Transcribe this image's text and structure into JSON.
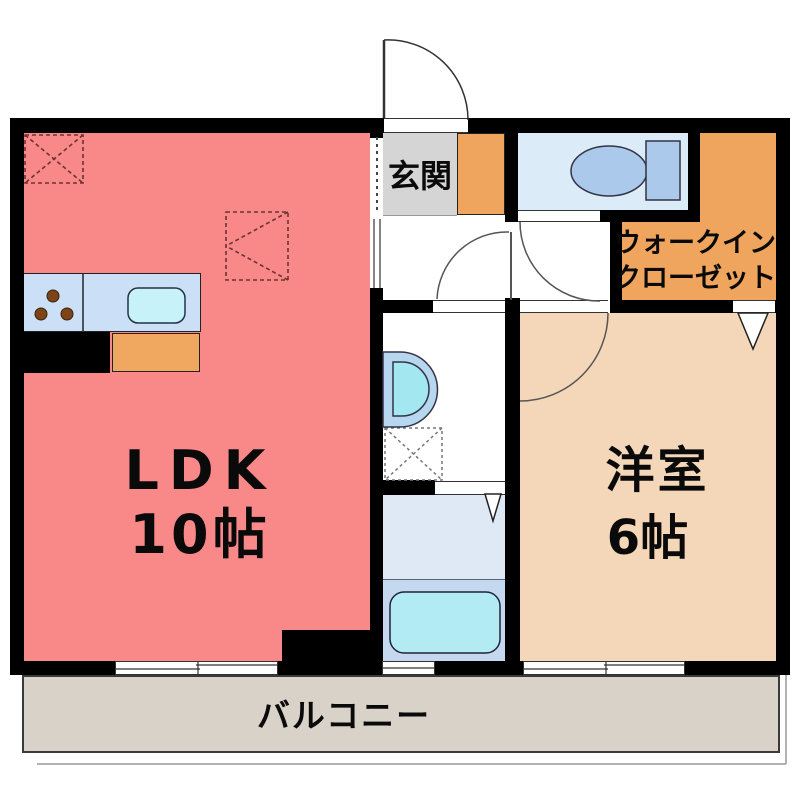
{
  "floor_plan": {
    "ldk": {
      "line1": "LDK",
      "line2": "10帖",
      "floor_color": "#f98888"
    },
    "bedroom": {
      "line1": "洋室",
      "line2": "6帖",
      "floor_color": "#f4d6b8"
    },
    "walk_in_closet": {
      "line1": "ウォークイン",
      "line2": "クローゼット",
      "floor_color": "#f0a55e"
    },
    "entrance": {
      "label": "玄関",
      "floor_color": "#d5d5d6",
      "shoe_cabinet_color": "#f0a55e"
    },
    "balcony": {
      "label": "バルコニー",
      "floor_color": "#d9d2c8"
    },
    "toilet": {
      "floor_color": "#dcebf8",
      "fixture_color": "#aac9eb"
    },
    "bathroom": {
      "floor_upper_color": "#dfe9f6",
      "floor_lower_color": "#c4d9f0",
      "bathtub_color": "#b2ebf4"
    },
    "washroom": {
      "floor_color": "#ffffff",
      "washbasin_outer_color": "#b7d6f0",
      "washbasin_inner_color": "#a3e7f0"
    },
    "kitchen": {
      "counter_color": "#cbdff7",
      "sink_color": "#c7f2f9",
      "cabinet_color": "#f0a860",
      "base_color": "#000000",
      "burner_count": 3
    },
    "wall_color": "#000000"
  }
}
